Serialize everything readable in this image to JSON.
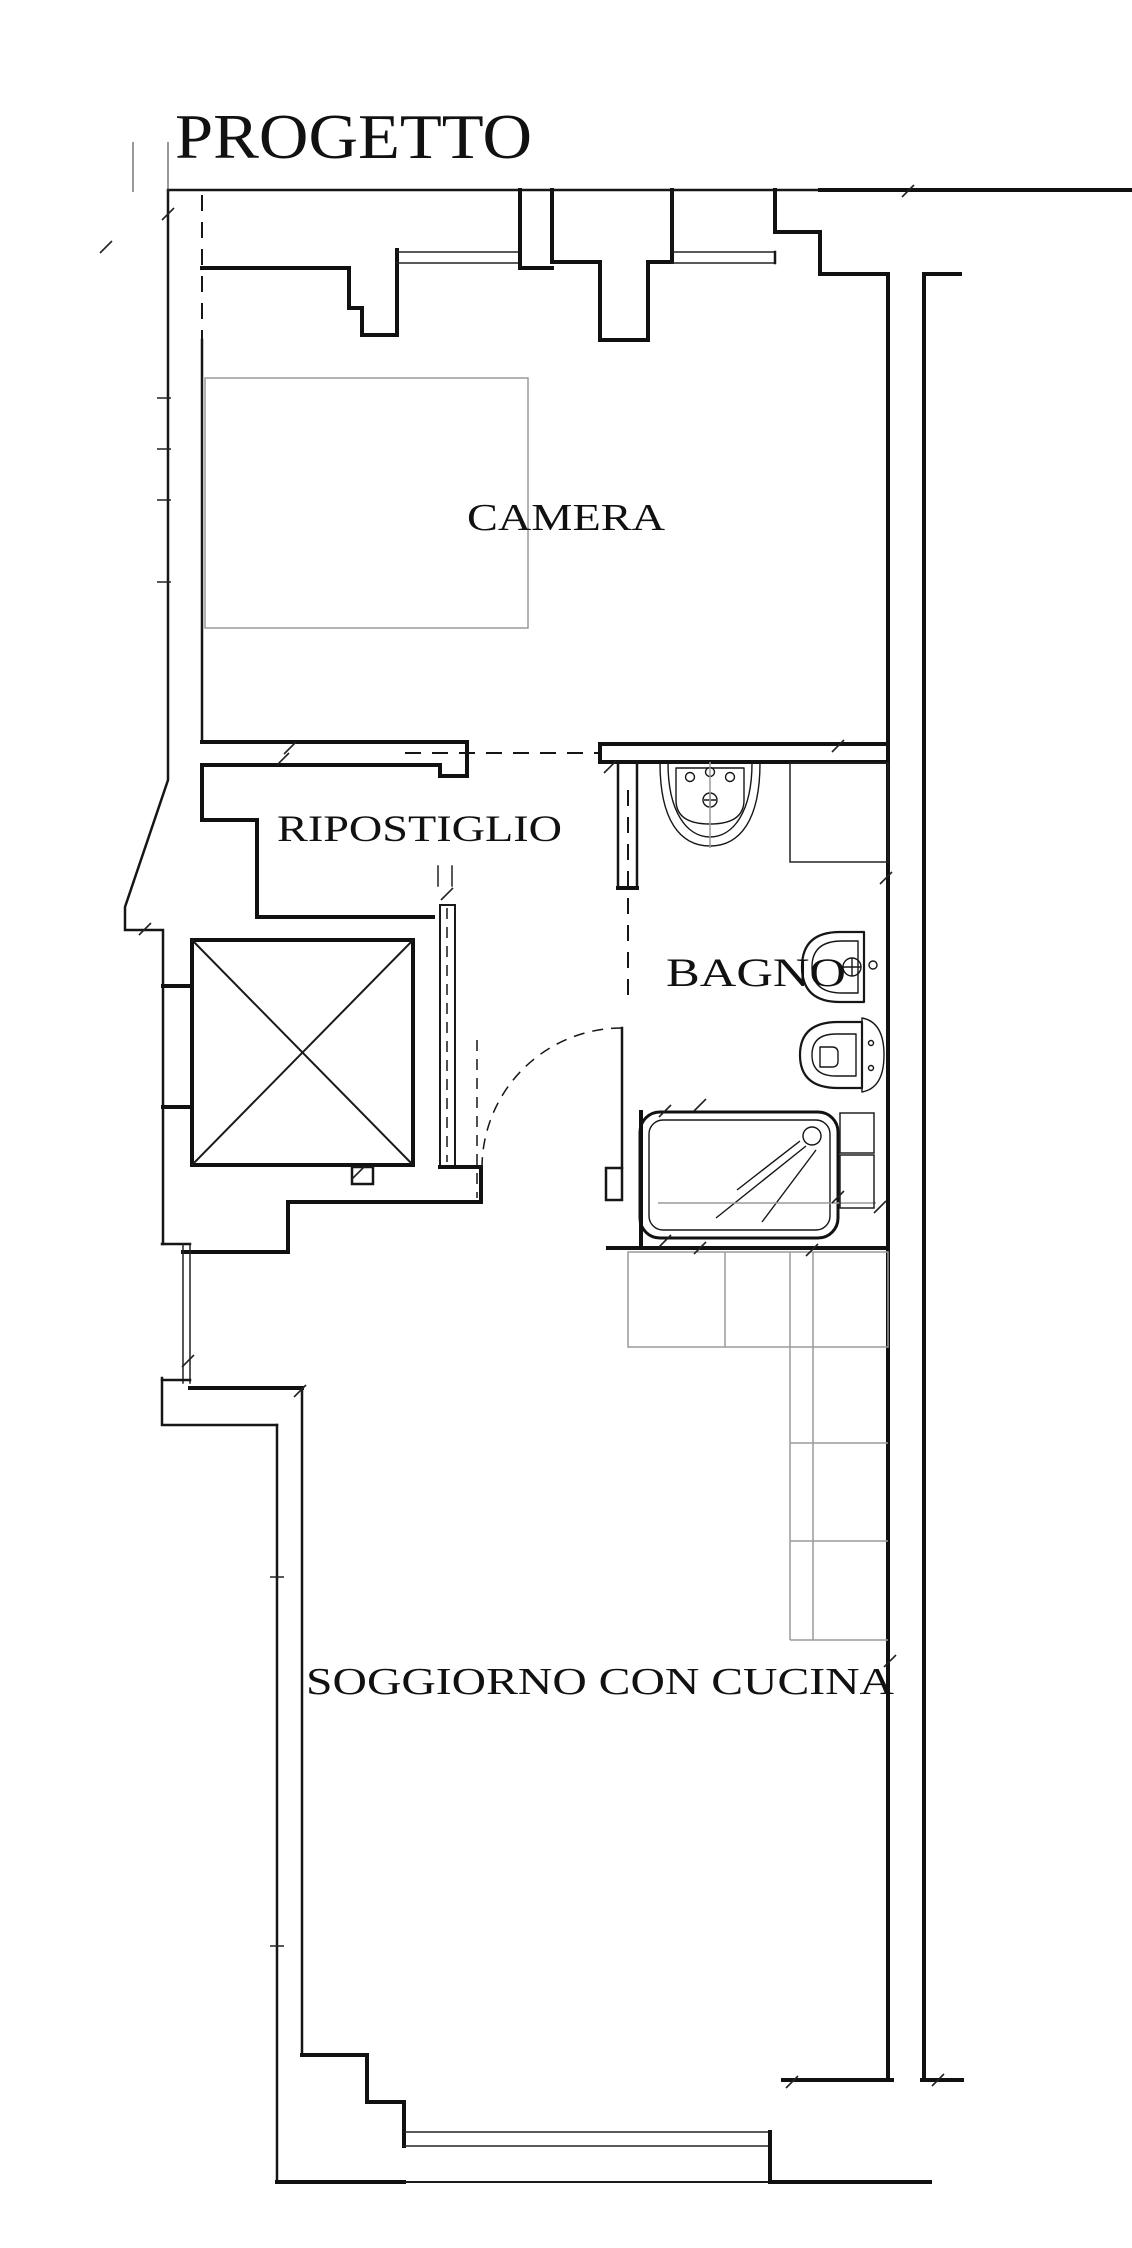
{
  "title": "PROGETTO",
  "rooms": {
    "camera": "CAMERA",
    "ripostiglio": "RIPOSTIGLIO",
    "bagno": "BAGNO",
    "soggiorno": "SOGGIORNO CON CUCINA"
  },
  "colors": {
    "ink": "#111111",
    "furniture_gray": "#9a9a9a",
    "background": "#ffffff"
  }
}
